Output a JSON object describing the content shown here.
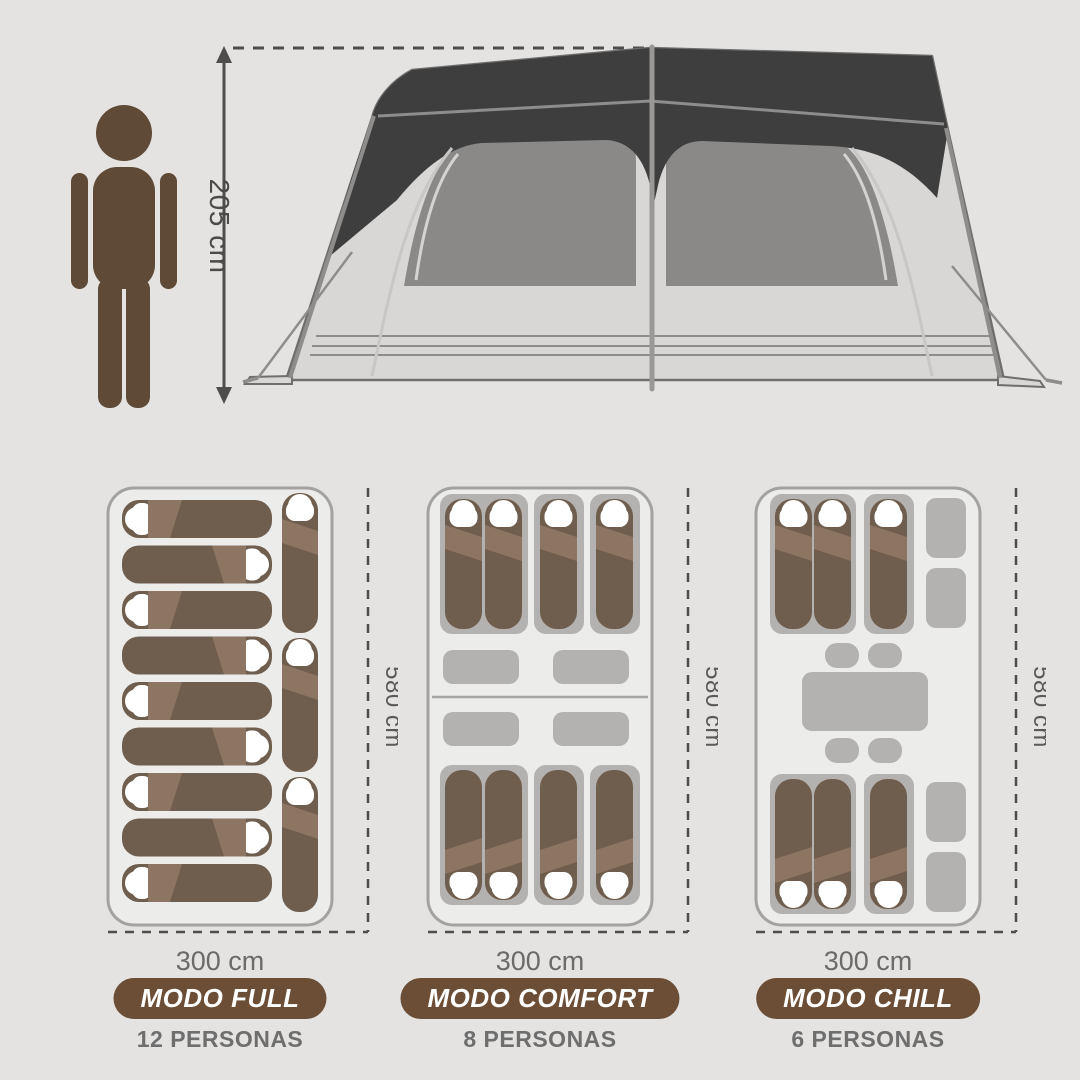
{
  "scale_figure": {
    "height_label": "205 cm"
  },
  "plans": [
    {
      "name": "modo-full",
      "mode_label": "MODO FULL",
      "persons_label": "12 PERSONAS",
      "width_label": "300 cm",
      "depth_label": "580 cm",
      "sleeping_bags": 12
    },
    {
      "name": "modo-comfort",
      "mode_label": "MODO COMFORT",
      "persons_label": "8 PERSONAS",
      "width_label": "300 cm",
      "depth_label": "580 cm",
      "sleeping_bags": 8
    },
    {
      "name": "modo-chill",
      "mode_label": "MODO CHILL",
      "persons_label": "6 PERSONAS",
      "width_label": "300 cm",
      "depth_label": "580 cm",
      "sleeping_bags": 6
    }
  ],
  "colors": {
    "background": "#e4e3e1",
    "figure": "#5e4a37",
    "dimension": "#4e4d4c",
    "canopy": "#3f3e3e",
    "tent_body": "#d8d7d6",
    "tent_outline": "#6f6e6d",
    "frame": "#8e8d8c",
    "window": "#8a8988",
    "plan_bg": "#ececeb",
    "plan_border": "#a3a2a1",
    "bag": "#6f5d4d",
    "fold": "#8d7563",
    "mat": "#b3b2b1",
    "pill": "#6b4e35",
    "pill_text": "#ffffff"
  }
}
